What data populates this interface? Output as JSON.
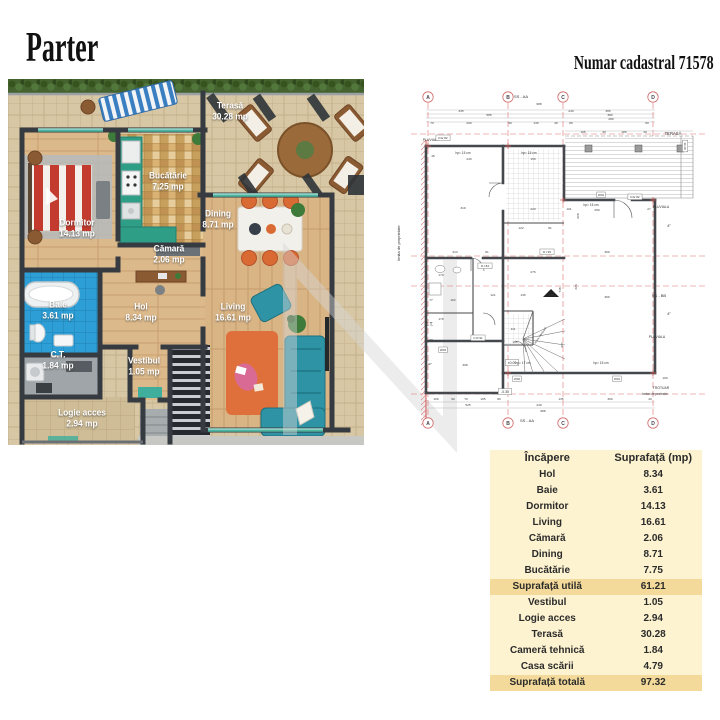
{
  "header": {
    "title": "Parter",
    "cadastral": "Numar cadastral 71578"
  },
  "colors": {
    "table_bg": "#fdf3d0",
    "table_highlight": "#f3da9a",
    "wall": "#363b41",
    "bed_red": "#c23b2e",
    "kitchen_teal": "#2f9e87",
    "bath_blue": "#2d9fd6",
    "accent_orange": "#d96a33",
    "sofa_teal": "#2d93a5",
    "cad_axis_red": "#d95f5f"
  },
  "floor_plan": {
    "rooms": [
      {
        "id": "dormitor",
        "name": "Dormitor",
        "area": "14.13 mp",
        "x": 69,
        "y": 150
      },
      {
        "id": "bucatarie",
        "name": "Bucătărie",
        "area": "7.25 mp",
        "x": 160,
        "y": 103
      },
      {
        "id": "camara",
        "name": "Cămară",
        "area": "2.06 mp",
        "x": 161,
        "y": 176
      },
      {
        "id": "terasa",
        "name": "Terasă",
        "area": "30.28 mp",
        "x": 222,
        "y": 33
      },
      {
        "id": "dining",
        "name": "Dining",
        "area": "8.71 mp",
        "x": 210,
        "y": 141
      },
      {
        "id": "living",
        "name": "Living",
        "area": "16.61 mp",
        "x": 225,
        "y": 234
      },
      {
        "id": "baie",
        "name": "Baie",
        "area": "3.61 mp",
        "x": 50,
        "y": 232
      },
      {
        "id": "hol",
        "name": "Hol",
        "area": "8.34 mp",
        "x": 133,
        "y": 234
      },
      {
        "id": "ct",
        "name": "C.T.",
        "area": "1.84 mp",
        "x": 50,
        "y": 282
      },
      {
        "id": "vestibul",
        "name": "Vestibul",
        "area": "1.05 mp",
        "x": 136,
        "y": 288
      },
      {
        "id": "logie",
        "name": "Logie acces",
        "area": "2.94 mp",
        "x": 74,
        "y": 340
      }
    ]
  },
  "technical_drawing": {
    "axis_markers": [
      {
        "label": "A",
        "x": 35
      },
      {
        "label": "B",
        "x": 115
      },
      {
        "label": "C",
        "x": 170
      },
      {
        "label": "D",
        "x": 260
      }
    ],
    "marker_top_y": 14,
    "marker_bottom_y": 340,
    "labels": [
      {
        "t": "limita de proprietate",
        "x": 7,
        "y": 160,
        "r": -90,
        "s": 4
      },
      {
        "t": "SS - AA",
        "x": 128,
        "y": 15,
        "s": 4
      },
      {
        "t": "SS - AA",
        "x": 134,
        "y": 339,
        "s": 4
      },
      {
        "t": "SS - BB",
        "x": 266,
        "y": 214,
        "s": 4
      },
      {
        "t": "TERASĂ",
        "x": 280,
        "y": 52,
        "s": 4.2
      },
      {
        "t": "PLUVIALA",
        "x": 38,
        "y": 58,
        "s": 3.4
      },
      {
        "t": "PLUVIALA",
        "x": 268,
        "y": 125,
        "s": 3.4
      },
      {
        "t": "PLUVIALA",
        "x": 264,
        "y": 255,
        "s": 3.4
      },
      {
        "t": "TROTUAR",
        "x": 268,
        "y": 306,
        "s": 3.4
      },
      {
        "t": "beton de protecție",
        "x": 262,
        "y": 312,
        "s": 3.2
      },
      {
        "t": "C.T.",
        "x": 36,
        "y": 243,
        "s": 5
      },
      {
        "t": "±0.00",
        "x": 119,
        "y": 281,
        "s": 3.4,
        "box": 1
      },
      {
        "t": "-0.35",
        "x": 112,
        "y": 310,
        "s": 3.4,
        "box": 1
      },
      {
        "t": "4°",
        "x": 276,
        "y": 144,
        "s": 4
      },
      {
        "t": "4°",
        "x": 276,
        "y": 232,
        "s": 4
      },
      {
        "t": "hp= 15 cm",
        "x": 70,
        "y": 71,
        "s": 3.2
      },
      {
        "t": "hp= 15 cm",
        "x": 136,
        "y": 71,
        "s": 3.2
      },
      {
        "t": "hp= 15 cm",
        "x": 198,
        "y": 123,
        "s": 3.2
      },
      {
        "t": "hp= 15 cm",
        "x": 208,
        "y": 281,
        "s": 3.2
      },
      {
        "t": "hp= 17 cm",
        "x": 130,
        "y": 281,
        "s": 3.2
      },
      {
        "t": "scara interioară",
        "x": 148,
        "y": 253,
        "r": -55,
        "s": 2.8
      },
      {
        "t": "D.E 82",
        "x": 50,
        "y": 56,
        "s": 3,
        "box": 1
      },
      {
        "t": "D.E 82",
        "x": 242,
        "y": 115,
        "s": 3,
        "box": 1
      },
      {
        "t": "W04",
        "x": 208,
        "y": 113,
        "s": 3,
        "box": 1
      },
      {
        "t": "W02",
        "x": 124,
        "y": 297,
        "s": 3,
        "box": 1
      },
      {
        "t": "W01",
        "x": 224,
        "y": 297,
        "s": 3,
        "box": 1
      },
      {
        "t": "W03",
        "x": 50,
        "y": 268,
        "s": 3,
        "box": 1
      },
      {
        "t": "D.I 84",
        "x": 92,
        "y": 184,
        "s": 3,
        "box": 1
      },
      {
        "t": "D.I 95",
        "x": 154,
        "y": 170,
        "s": 3,
        "box": 1
      },
      {
        "t": "C.R 91",
        "x": 85,
        "y": 256,
        "s": 3,
        "box": 1
      },
      {
        "t": "30.28",
        "x": 291,
        "y": 63,
        "r": 90,
        "s": 2.8,
        "box": 1
      }
    ],
    "dims": [
      {
        "t": "988",
        "x": 146,
        "y": 22
      },
      {
        "t": "335",
        "x": 68,
        "y": 29
      },
      {
        "t": "240",
        "x": 178,
        "y": 29
      },
      {
        "t": "365",
        "x": 215,
        "y": 29
      },
      {
        "t": "585",
        "x": 96,
        "y": 33
      },
      {
        "t": "380",
        "x": 217,
        "y": 33
      },
      {
        "t": "280",
        "x": 218,
        "y": 37
      },
      {
        "t": "70",
        "x": 39,
        "y": 41
      },
      {
        "t": "200",
        "x": 76,
        "y": 41
      },
      {
        "t": "90",
        "x": 117,
        "y": 41
      },
      {
        "t": "130",
        "x": 143,
        "y": 41
      },
      {
        "t": "40",
        "x": 163,
        "y": 41
      },
      {
        "t": "80",
        "x": 178,
        "y": 41
      },
      {
        "t": "60",
        "x": 254,
        "y": 41
      },
      {
        "t": "165",
        "x": 190,
        "y": 50
      },
      {
        "t": "30",
        "x": 211,
        "y": 50
      },
      {
        "t": "180",
        "x": 231,
        "y": 50
      },
      {
        "t": "30",
        "x": 252,
        "y": 50
      },
      {
        "t": "45",
        "x": 40,
        "y": 74
      },
      {
        "t": "230",
        "x": 76,
        "y": 77
      },
      {
        "t": "150",
        "x": 140,
        "y": 77
      },
      {
        "t": "319",
        "x": 70,
        "y": 126
      },
      {
        "t": "220",
        "x": 140,
        "y": 127
      },
      {
        "t": "101",
        "x": 176,
        "y": 127
      },
      {
        "t": "250",
        "x": 204,
        "y": 128
      },
      {
        "t": "27",
        "x": 256,
        "y": 127
      },
      {
        "t": "122",
        "x": 128,
        "y": 146
      },
      {
        "t": "81",
        "x": 157,
        "y": 146
      },
      {
        "t": "314",
        "x": 62,
        "y": 170
      },
      {
        "t": "81",
        "x": 94,
        "y": 170
      },
      {
        "t": "369",
        "x": 214,
        "y": 170
      },
      {
        "t": "369",
        "x": 214,
        "y": 215
      },
      {
        "t": "748",
        "x": 168,
        "y": 207,
        "r": -90
      },
      {
        "t": "223",
        "x": 184,
        "y": 204,
        "r": -90
      },
      {
        "t": "608",
        "x": 186,
        "y": 133,
        "r": -90
      },
      {
        "t": "276",
        "x": 140,
        "y": 190
      },
      {
        "t": "179",
        "x": 48,
        "y": 193
      },
      {
        "t": "121",
        "x": 100,
        "y": 213
      },
      {
        "t": "136",
        "x": 130,
        "y": 213
      },
      {
        "t": "106",
        "x": 158,
        "y": 213
      },
      {
        "t": "179",
        "x": 48,
        "y": 237
      },
      {
        "t": "77",
        "x": 38,
        "y": 218
      },
      {
        "t": "102",
        "x": 60,
        "y": 218
      },
      {
        "t": "77",
        "x": 38,
        "y": 258
      },
      {
        "t": "97",
        "x": 37,
        "y": 282
      },
      {
        "t": "308",
        "x": 72,
        "y": 283
      },
      {
        "t": "111",
        "x": 120,
        "y": 247
      },
      {
        "t": "165",
        "x": 122,
        "y": 260
      },
      {
        "t": "207",
        "x": 170,
        "y": 262,
        "r": -90
      },
      {
        "t": "100",
        "x": 272,
        "y": 296
      },
      {
        "t": "100",
        "x": 43,
        "y": 317
      },
      {
        "t": "90",
        "x": 60,
        "y": 317
      },
      {
        "t": "70",
        "x": 73,
        "y": 317
      },
      {
        "t": "105",
        "x": 90,
        "y": 317
      },
      {
        "t": "80",
        "x": 106,
        "y": 317
      },
      {
        "t": "135",
        "x": 168,
        "y": 317
      },
      {
        "t": "300",
        "x": 217,
        "y": 317
      },
      {
        "t": "40",
        "x": 257,
        "y": 317
      },
      {
        "t": "525",
        "x": 75,
        "y": 323
      },
      {
        "t": "240",
        "x": 146,
        "y": 323
      },
      {
        "t": "988",
        "x": 150,
        "y": 329
      }
    ]
  },
  "area_table": {
    "col_room": "Încăpere",
    "col_area": "Suprafață (mp)",
    "rows": [
      {
        "room": "Hol",
        "area": "8.34",
        "hl": false
      },
      {
        "room": "Baie",
        "area": "3.61",
        "hl": false
      },
      {
        "room": "Dormitor",
        "area": "14.13",
        "hl": false
      },
      {
        "room": "Living",
        "area": "16.61",
        "hl": false
      },
      {
        "room": "Cămară",
        "area": "2.06",
        "hl": false
      },
      {
        "room": "Dining",
        "area": "8.71",
        "hl": false
      },
      {
        "room": "Bucătărie",
        "area": "7.75",
        "hl": false
      },
      {
        "room": "Suprafață utilă",
        "area": "61.21",
        "hl": true
      },
      {
        "room": "Vestibul",
        "area": "1.05",
        "hl": false
      },
      {
        "room": "Logie acces",
        "area": "2.94",
        "hl": false
      },
      {
        "room": "Terasă",
        "area": "30.28",
        "hl": false
      },
      {
        "room": "Cameră tehnică",
        "area": "1.84",
        "hl": false
      },
      {
        "room": "Casa scării",
        "area": "4.79",
        "hl": false
      },
      {
        "room": "Suprafață totală",
        "area": "97.32",
        "hl": true
      }
    ]
  }
}
